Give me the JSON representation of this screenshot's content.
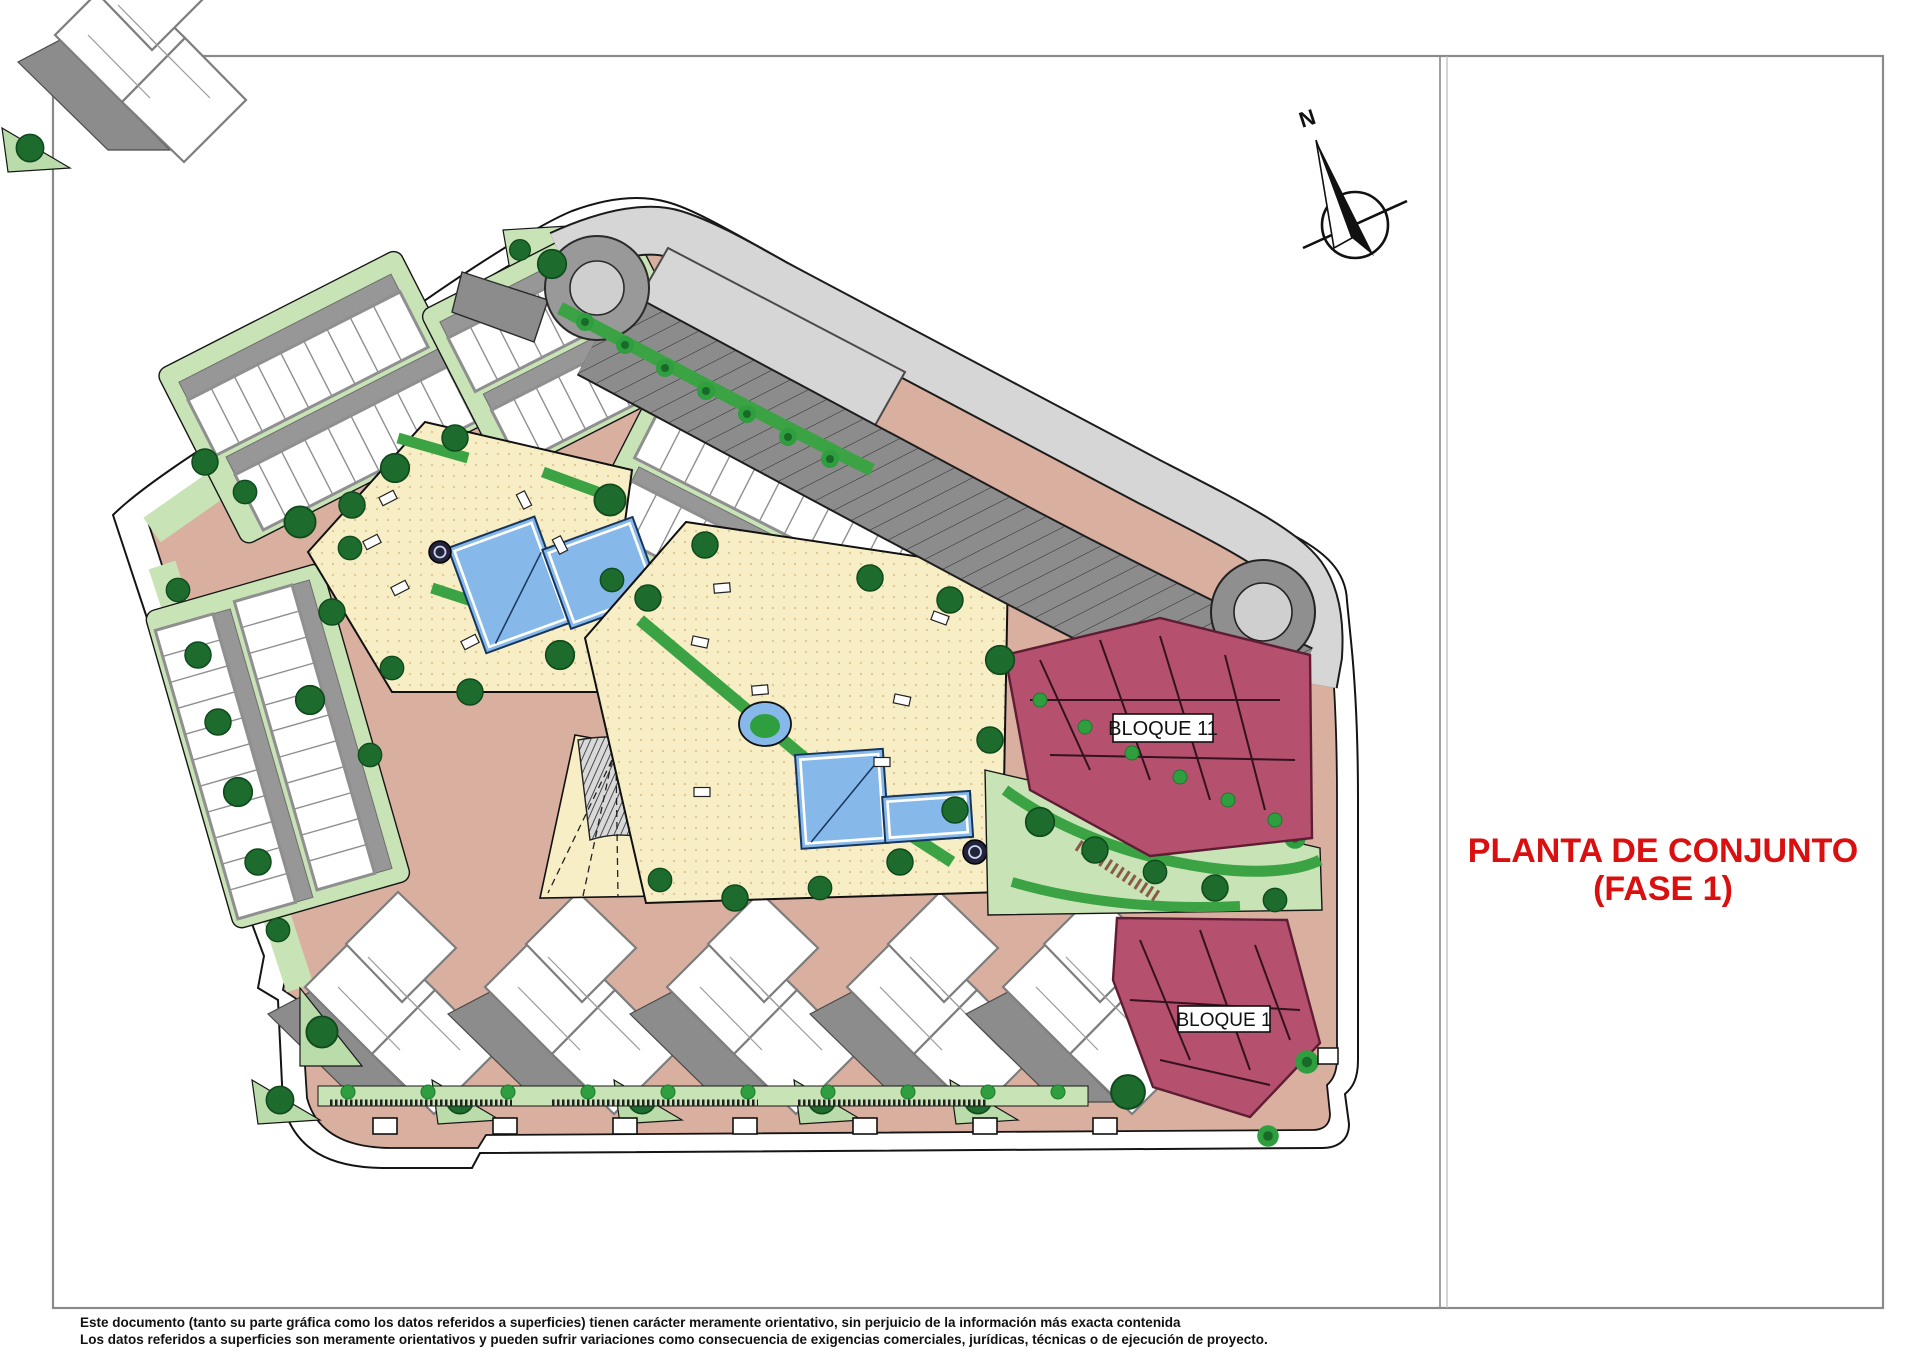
{
  "document": {
    "type": "architectural site plan",
    "title": {
      "line1": "PLANTA DE CONJUNTO",
      "line2": "(FASE 1)",
      "color": "#da1010"
    },
    "compass": {
      "north_label": "N"
    },
    "blocks": {
      "bloque11_label": "BLOQUE 11",
      "bloque1_label": "BLOQUE 1"
    },
    "disclaimer": {
      "line1": "Este documento (tanto su parte gráfica como los datos referidos a superficies) tienen carácter meramente orientativo, sin perjuicio de la información más exacta contenida",
      "line2": "Los datos referidos a superficies son meramente orientativos y pueden sufrir variaciones como consecuencia de exigencias comerciales, jurídicas, técnicas o de ejecución de proyecto."
    },
    "colors": {
      "frame": "#8a8a8a",
      "boundary_band": "#ffffff",
      "road_salmon": "#d9af9f",
      "access_road_gray": "#d6d6d6",
      "parking_gray": "#8c8c8c",
      "lawn_green": "#c8e4b6",
      "hedge_green": "#3ba343",
      "tree_dark_green": "#1d6b2d",
      "pool_deck_cream": "#f8eec6",
      "pool_blue": "#86b8e9",
      "block_maroon": "#b5506e",
      "house_white": "#ffffff",
      "house_outline_gray": "#8f8f8f"
    }
  }
}
